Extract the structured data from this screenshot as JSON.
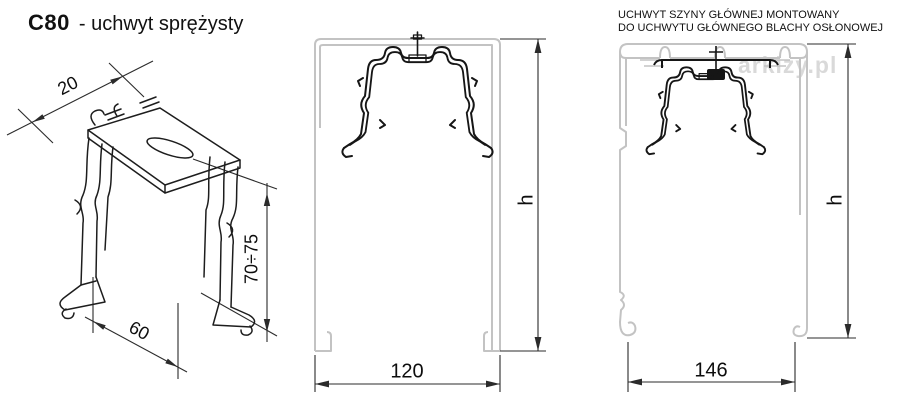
{
  "title": {
    "code": "C80",
    "suffix": "- uchwyt sprężysty"
  },
  "right_view_title": {
    "line1": "UCHWYT SZYNY GŁÓWNEJ MONTOWANY",
    "line2": "DO UCHWYTU GŁÓWNEGO BLACHY OSŁONOWEJ"
  },
  "watermark": {
    "text": "arkizy.pl"
  },
  "iso_view": {
    "dim_top": "20",
    "dim_bottom": "60",
    "dim_height": "70÷75"
  },
  "middle_view": {
    "dim_width": "120",
    "dim_height": "h"
  },
  "right_view": {
    "dim_width": "146",
    "dim_height": "h"
  },
  "colors": {
    "line": "#161616",
    "profile": "#c3c3c3",
    "dim": "#2b2b2b",
    "watermark": "#d3d3d3",
    "text": "#111111"
  }
}
